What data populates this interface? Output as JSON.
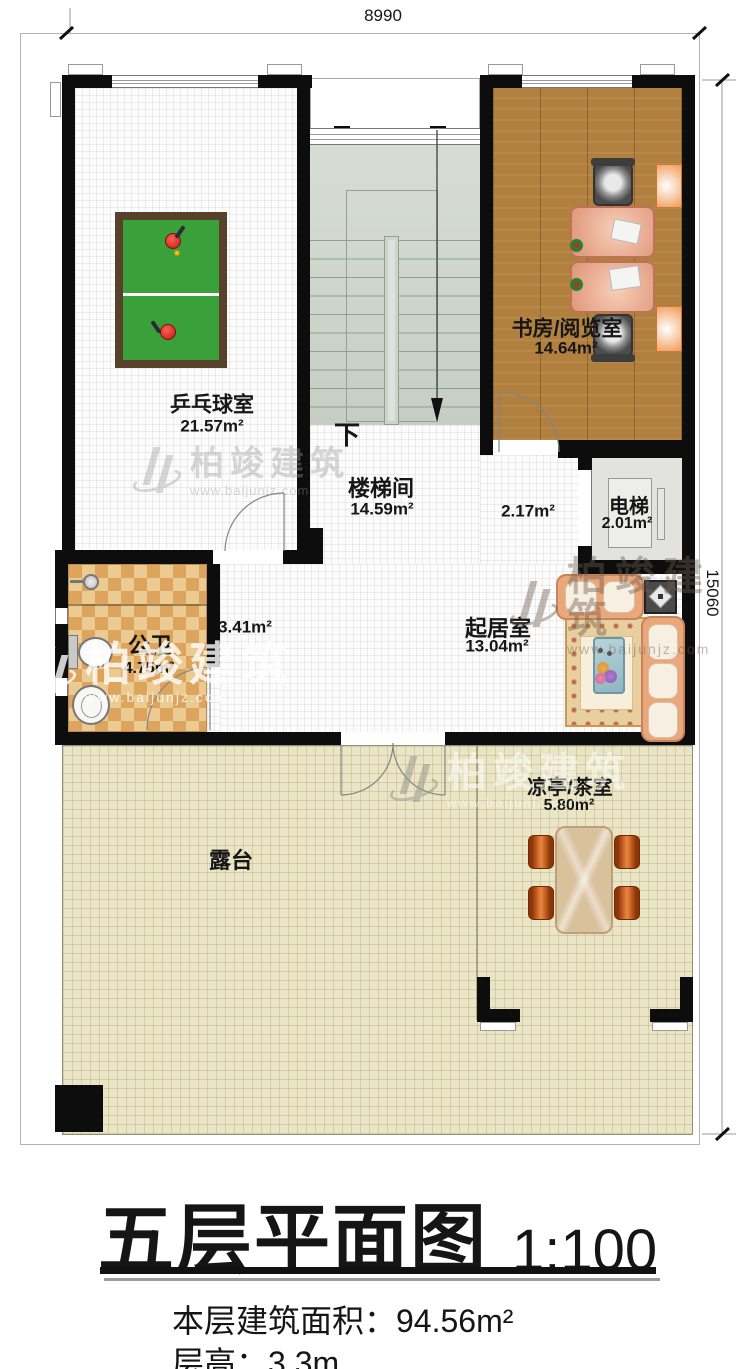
{
  "plan": {
    "dimensions": {
      "width_mm": "8990",
      "height_mm": "15060"
    },
    "stairs": {
      "direction_label": "下"
    },
    "rooms": {
      "table_tennis": {
        "name": "乒乓球室",
        "area": "21.57m²"
      },
      "study": {
        "name": "书房/阅览室",
        "area": "14.64m²"
      },
      "stair_hall": {
        "name": "楼梯间",
        "area": "14.59m²"
      },
      "corridor": {
        "area": "2.17m²"
      },
      "elevator": {
        "name": "电梯",
        "area": "2.01m²"
      },
      "bathroom": {
        "name": "公卫",
        "area": "4.75m²"
      },
      "hall": {
        "area": "3.41m²"
      },
      "living": {
        "name": "起居室",
        "area": "13.04m²"
      },
      "pavilion": {
        "name": "凉亭/茶室",
        "area": "5.80m²"
      },
      "terrace": {
        "name": "露台"
      }
    }
  },
  "title_block": {
    "title": "五层平面图",
    "scale": "1:100",
    "floor_area": "本层建筑面积：94.56m²",
    "floor_height": "层高：3.3m"
  },
  "watermark": {
    "name": "柏竣建筑",
    "url": "www.baijunjz.com"
  },
  "colors": {
    "wall": "#0d0d0d",
    "wood_floor": "#b17f3e",
    "stair_floor": "#ccd3c7",
    "tile_light": "#eccb93",
    "tile_dark": "#dda45e",
    "terrace_floor": "#ebe5c8",
    "pingpong_green": "#3aa13a",
    "pingpong_frame": "#57412a",
    "sofa_salmon": "#e8a47e",
    "coffee_table_teal": "#9fc3cd",
    "tea_chair_orange": "#d9752f"
  }
}
